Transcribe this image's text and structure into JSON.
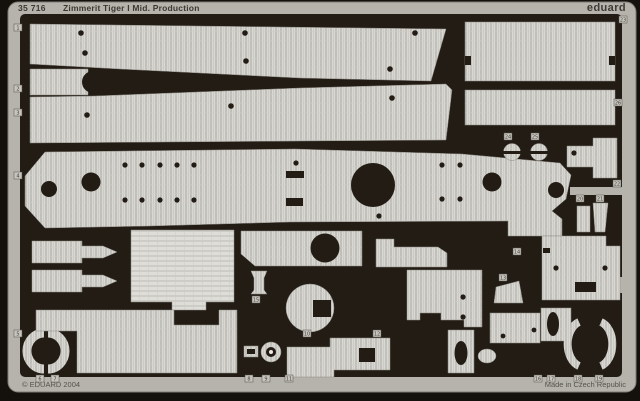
{
  "header": {
    "catalog_number": "35 716",
    "title": "Zimmerit Tiger I Mid. Production",
    "brand": "eduard"
  },
  "footer": {
    "copyright": "© EDUARD 2004",
    "made_in": "Made in Czech Republic"
  },
  "colors": {
    "background": "#14100c",
    "field": "#221c15",
    "frame": "#b5b3ab",
    "frame_edge": "#7d7b73",
    "part_light": "#d9d8d3",
    "part_ridge": "#a8a6a0",
    "text_dark": "#3c3933",
    "tag_fill": "#c6c4bd"
  },
  "etch": {
    "part_tags": [
      {
        "x": 14,
        "y": 24,
        "label": "1"
      },
      {
        "x": 14,
        "y": 85,
        "label": "2"
      },
      {
        "x": 14,
        "y": 109,
        "label": "3"
      },
      {
        "x": 14,
        "y": 172,
        "label": "4"
      },
      {
        "x": 14,
        "y": 330,
        "label": "5"
      },
      {
        "x": 36,
        "y": 375,
        "label": "6"
      },
      {
        "x": 51,
        "y": 375,
        "label": "7"
      },
      {
        "x": 245,
        "y": 375,
        "label": "8"
      },
      {
        "x": 262,
        "y": 375,
        "label": "9"
      },
      {
        "x": 303,
        "y": 330,
        "label": "10"
      },
      {
        "x": 285,
        "y": 375,
        "label": "11"
      },
      {
        "x": 373,
        "y": 330,
        "label": "12"
      },
      {
        "x": 499,
        "y": 274,
        "label": "13"
      },
      {
        "x": 513,
        "y": 248,
        "label": "14"
      },
      {
        "x": 252,
        "y": 296,
        "label": "15"
      },
      {
        "x": 534,
        "y": 375,
        "label": "16"
      },
      {
        "x": 547,
        "y": 375,
        "label": "17"
      },
      {
        "x": 574,
        "y": 375,
        "label": "18"
      },
      {
        "x": 595,
        "y": 375,
        "label": "19"
      },
      {
        "x": 576,
        "y": 195,
        "label": "20"
      },
      {
        "x": 596,
        "y": 195,
        "label": "21"
      },
      {
        "x": 613,
        "y": 180,
        "label": "22"
      },
      {
        "x": 619,
        "y": 16,
        "label": "23"
      },
      {
        "x": 504,
        "y": 133,
        "label": "24"
      },
      {
        "x": 531,
        "y": 133,
        "label": "25"
      },
      {
        "x": 614,
        "y": 99,
        "label": "26"
      }
    ],
    "shapes": [
      {
        "name": "roof-strip-upper",
        "kind": "poly",
        "pts": "30,24 446,29 431,81 300,78 120,69 30,64",
        "fill": "tex"
      },
      {
        "name": "hole",
        "kind": "circle",
        "cx": 81,
        "cy": 33,
        "r": 2.8,
        "fill": "dark"
      },
      {
        "name": "hole",
        "kind": "circle",
        "cx": 85,
        "cy": 53,
        "r": 2.8,
        "fill": "dark"
      },
      {
        "name": "hole",
        "kind": "circle",
        "cx": 245,
        "cy": 33,
        "r": 2.8,
        "fill": "dark"
      },
      {
        "name": "hole",
        "kind": "circle",
        "cx": 246,
        "cy": 61,
        "r": 2.8,
        "fill": "dark"
      },
      {
        "name": "hole",
        "kind": "circle",
        "cx": 415,
        "cy": 33,
        "r": 2.8,
        "fill": "dark"
      },
      {
        "name": "hole",
        "kind": "circle",
        "cx": 390,
        "cy": 69,
        "r": 2.8,
        "fill": "dark"
      },
      {
        "name": "bracket-part",
        "kind": "poly",
        "pts": "30,69 88,69 88,95 30,95",
        "fill": "tex"
      },
      {
        "name": "bracket-notch",
        "kind": "circle",
        "cx": 93,
        "cy": 82,
        "r": 11,
        "fill": "dark"
      },
      {
        "name": "roof-strip-lower",
        "kind": "poly",
        "pts": "30,97 95,96 300,88 446,84 452,90 446,140 300,141 30,143",
        "fill": "tex"
      },
      {
        "name": "hole",
        "kind": "circle",
        "cx": 87,
        "cy": 115,
        "r": 2.8,
        "fill": "dark"
      },
      {
        "name": "hole",
        "kind": "circle",
        "cx": 231,
        "cy": 106,
        "r": 2.8,
        "fill": "dark"
      },
      {
        "name": "hole",
        "kind": "circle",
        "cx": 392,
        "cy": 98,
        "r": 2.8,
        "fill": "dark"
      },
      {
        "name": "side-plate-upper",
        "kind": "rect",
        "x": 465,
        "y": 22,
        "w": 150,
        "h": 59,
        "fill": "tex"
      },
      {
        "name": "edge-notch",
        "kind": "rect",
        "x": 465,
        "y": 56,
        "w": 6,
        "h": 9,
        "fill": "dark"
      },
      {
        "name": "edge-notch",
        "kind": "rect",
        "x": 609,
        "y": 56,
        "w": 6,
        "h": 9,
        "fill": "dark"
      },
      {
        "name": "side-plate-lower",
        "kind": "rect",
        "x": 465,
        "y": 90,
        "w": 150,
        "h": 35,
        "fill": "tex"
      },
      {
        "name": "engine-deck-plate",
        "kind": "poly",
        "pts": "25,176 45,152 295,149 462,154 560,163 571,175 566,199 552,211 562,219 562,236 508,236 508,221 290,222 150,226 45,228 25,206",
        "fill": "tex"
      },
      {
        "name": "hole",
        "kind": "circle",
        "cx": 49,
        "cy": 189,
        "r": 8,
        "fill": "dark"
      },
      {
        "name": "hole",
        "kind": "circle",
        "cx": 91,
        "cy": 182,
        "r": 9.5,
        "fill": "dark"
      },
      {
        "name": "fan-opening",
        "kind": "circle",
        "cx": 373,
        "cy": 185,
        "r": 22,
        "fill": "dark"
      },
      {
        "name": "hole",
        "kind": "circle",
        "cx": 492,
        "cy": 182,
        "r": 9.5,
        "fill": "dark"
      },
      {
        "name": "hole",
        "kind": "circle",
        "cx": 556,
        "cy": 190,
        "r": 8,
        "fill": "dark"
      },
      {
        "name": "hole",
        "kind": "circle",
        "cx": 125,
        "cy": 165,
        "r": 2.6,
        "fill": "dark"
      },
      {
        "name": "hole",
        "kind": "circle",
        "cx": 142,
        "cy": 165,
        "r": 2.6,
        "fill": "dark"
      },
      {
        "name": "hole",
        "kind": "circle",
        "cx": 160,
        "cy": 165,
        "r": 2.6,
        "fill": "dark"
      },
      {
        "name": "hole",
        "kind": "circle",
        "cx": 177,
        "cy": 165,
        "r": 2.6,
        "fill": "dark"
      },
      {
        "name": "hole",
        "kind": "circle",
        "cx": 194,
        "cy": 165,
        "r": 2.6,
        "fill": "dark"
      },
      {
        "name": "hole",
        "kind": "circle",
        "cx": 125,
        "cy": 200,
        "r": 2.6,
        "fill": "dark"
      },
      {
        "name": "hole",
        "kind": "circle",
        "cx": 142,
        "cy": 200,
        "r": 2.6,
        "fill": "dark"
      },
      {
        "name": "hole",
        "kind": "circle",
        "cx": 160,
        "cy": 200,
        "r": 2.6,
        "fill": "dark"
      },
      {
        "name": "hole",
        "kind": "circle",
        "cx": 177,
        "cy": 200,
        "r": 2.6,
        "fill": "dark"
      },
      {
        "name": "hole",
        "kind": "circle",
        "cx": 194,
        "cy": 200,
        "r": 2.6,
        "fill": "dark"
      },
      {
        "name": "hole",
        "kind": "circle",
        "cx": 296,
        "cy": 163,
        "r": 2.6,
        "fill": "dark"
      },
      {
        "name": "hole",
        "kind": "circle",
        "cx": 442,
        "cy": 165,
        "r": 2.6,
        "fill": "dark"
      },
      {
        "name": "hole",
        "kind": "circle",
        "cx": 460,
        "cy": 165,
        "r": 2.6,
        "fill": "dark"
      },
      {
        "name": "hole",
        "kind": "circle",
        "cx": 442,
        "cy": 199,
        "r": 2.6,
        "fill": "dark"
      },
      {
        "name": "hole",
        "kind": "circle",
        "cx": 460,
        "cy": 199,
        "r": 2.6,
        "fill": "dark"
      },
      {
        "name": "hole",
        "kind": "circle",
        "cx": 379,
        "cy": 216,
        "r": 2.6,
        "fill": "dark"
      },
      {
        "name": "slot",
        "kind": "rect",
        "x": 286,
        "y": 171,
        "w": 18,
        "h": 7,
        "fill": "dark"
      },
      {
        "name": "slot",
        "kind": "rect",
        "x": 286,
        "y": 198,
        "w": 17,
        "h": 8,
        "fill": "dark"
      },
      {
        "name": "periscope-disc",
        "kind": "circle",
        "cx": 512,
        "cy": 152,
        "r": 8.5,
        "fill": "tex"
      },
      {
        "name": "disc-slot",
        "kind": "rect",
        "x": 503,
        "y": 151,
        "w": 18,
        "h": 3,
        "fill": "dark"
      },
      {
        "name": "periscope-disc",
        "kind": "circle",
        "cx": 539,
        "cy": 152,
        "r": 8.5,
        "fill": "tex"
      },
      {
        "name": "disc-slot",
        "kind": "rect",
        "x": 530,
        "y": 151,
        "w": 18,
        "h": 3,
        "fill": "dark"
      },
      {
        "name": "tee-part",
        "kind": "poly",
        "pts": "593,138 617,138 617,178 593,178 593,167 567,167 567,146 593,146",
        "fill": "tex"
      },
      {
        "name": "hole",
        "kind": "circle",
        "cx": 574,
        "cy": 153,
        "r": 2.6,
        "fill": "dark"
      },
      {
        "name": "small-rect-part",
        "kind": "rect",
        "x": 577,
        "y": 206,
        "w": 13,
        "h": 26,
        "fill": "tex"
      },
      {
        "name": "wedge-part",
        "kind": "poly",
        "pts": "593,203 608,203 605,232 595,232",
        "fill": "tex"
      },
      {
        "name": "exhaust-cover-upper",
        "kind": "poly",
        "pts": "32,241 82,241 82,246 103,246 117,252 103,258 82,258 82,263 32,263",
        "fill": "tex"
      },
      {
        "name": "exhaust-cover-lower",
        "kind": "poly",
        "pts": "32,270 82,270 82,275 103,275 117,281 103,287 82,287 82,292 32,292",
        "fill": "tex"
      },
      {
        "name": "large-square-plate",
        "kind": "poly",
        "pts": "131,230 234,230 234,302 206,302 206,310 172,310 172,302 131,302",
        "fill": "tex2"
      },
      {
        "name": "fan-cover-plate",
        "kind": "poly",
        "pts": "241,231 362,231 362,266 255,266 241,254",
        "fill": "tex"
      },
      {
        "name": "hole",
        "kind": "circle",
        "cx": 325,
        "cy": 248,
        "r": 14.5,
        "fill": "dark"
      },
      {
        "name": "small-bottle-part",
        "kind": "poly",
        "pts": "251,271 267,271 264,278 264,290 267,294 251,294 254,290 254,278",
        "fill": "tex"
      },
      {
        "name": "round-cover-part",
        "kind": "circle",
        "cx": 310,
        "cy": 308,
        "r": 24,
        "fill": "tex"
      },
      {
        "name": "square-cutout",
        "kind": "rect",
        "x": 313,
        "y": 300,
        "w": 18,
        "h": 17,
        "fill": "dark"
      },
      {
        "name": "notched-plate",
        "kind": "poly",
        "pts": "376,239 394,239 394,247 438,247 447,253 447,267 376,267",
        "fill": "tex"
      },
      {
        "name": "hatch-plate",
        "kind": "poly",
        "pts": "407,270 482,270 482,327 464,327 464,320 441,320 441,313 420,313 420,320 407,320",
        "fill": "tex"
      },
      {
        "name": "hole",
        "kind": "circle",
        "cx": 463,
        "cy": 297,
        "r": 2.6,
        "fill": "dark"
      },
      {
        "name": "hole",
        "kind": "circle",
        "cx": 463,
        "cy": 317,
        "r": 2.6,
        "fill": "dark"
      },
      {
        "name": "curved-wedge-part",
        "kind": "poly",
        "pts": "496,287 519,281 523,303 494,303",
        "fill": "tex"
      },
      {
        "name": "rear-plate",
        "kind": "poly",
        "pts": "542,236 606,236 606,246 620,246 620,300 542,300",
        "fill": "tex"
      },
      {
        "name": "corner-notch",
        "kind": "rect",
        "x": 543,
        "y": 248,
        "w": 7,
        "h": 5,
        "fill": "dark"
      },
      {
        "name": "hole",
        "kind": "circle",
        "cx": 556,
        "cy": 268,
        "r": 2.6,
        "fill": "dark"
      },
      {
        "name": "hole",
        "kind": "circle",
        "cx": 605,
        "cy": 268,
        "r": 2.6,
        "fill": "dark"
      },
      {
        "name": "slot",
        "kind": "rect",
        "x": 575,
        "y": 282,
        "w": 21,
        "h": 10,
        "fill": "dark"
      },
      {
        "name": "fender-arc-left",
        "kind": "arc",
        "d": "M44,333 A17,18 0 0 0 44,369",
        "w": 9,
        "fill": "tex"
      },
      {
        "name": "fender-arc-right",
        "kind": "arc",
        "d": "M48,333 A17,18 0 0 1 48,369",
        "w": 9,
        "fill": "tex"
      },
      {
        "name": "bottom-left-plate",
        "kind": "poly",
        "pts": "36,310 174,310 174,325 219,325 219,310 237,310 237,373 77,373 77,331 36,331",
        "fill": "tex"
      },
      {
        "name": "small-slotted-part",
        "kind": "rect",
        "x": 244,
        "y": 346,
        "w": 14,
        "h": 11,
        "fill": "tex"
      },
      {
        "name": "slot",
        "kind": "rect",
        "x": 247,
        "y": 349,
        "w": 8,
        "h": 5,
        "fill": "dark"
      },
      {
        "name": "washer-part",
        "kind": "circle",
        "cx": 271,
        "cy": 352,
        "r": 10,
        "fill": "tex"
      },
      {
        "name": "washer-hole",
        "kind": "circle",
        "cx": 271,
        "cy": 352,
        "r": 5,
        "fill": "dark"
      },
      {
        "name": "washer-center",
        "kind": "circle",
        "cx": 271,
        "cy": 352,
        "r": 2,
        "fill": "light"
      },
      {
        "name": "bottom-center-plate",
        "kind": "poly",
        "pts": "287,347 330,347 330,338 390,338 390,370 334,370 334,377 287,377",
        "fill": "tex"
      },
      {
        "name": "plate-notch",
        "kind": "rect",
        "x": 359,
        "y": 348,
        "w": 16,
        "h": 14,
        "fill": "dark"
      },
      {
        "name": "oval-hole-part",
        "kind": "poly",
        "pts": "448,330 474,330 474,373 448,373",
        "fill": "tex"
      },
      {
        "name": "oval-cutout",
        "kind": "ellipse",
        "cx": 461,
        "cy": 353,
        "rx": 6.5,
        "ry": 12,
        "fill": "dark"
      },
      {
        "name": "small-oval-part",
        "kind": "ellipse",
        "cx": 487,
        "cy": 356,
        "rx": 9,
        "ry": 7,
        "fill": "tex"
      },
      {
        "name": "bottom-plate-right",
        "kind": "rect",
        "x": 490,
        "y": 313,
        "w": 50,
        "h": 30,
        "fill": "tex"
      },
      {
        "name": "hole",
        "kind": "circle",
        "cx": 503,
        "cy": 336,
        "r": 2.4,
        "fill": "dark"
      },
      {
        "name": "hole",
        "kind": "circle",
        "cx": 534,
        "cy": 330,
        "r": 2.4,
        "fill": "dark"
      },
      {
        "name": "oval-hole-part-b",
        "kind": "rect",
        "x": 541,
        "y": 308,
        "w": 30,
        "h": 33,
        "fill": "tex"
      },
      {
        "name": "oval-cutout",
        "kind": "ellipse",
        "cx": 553,
        "cy": 324,
        "rx": 6,
        "ry": 12,
        "fill": "dark"
      },
      {
        "name": "fender-arc-left-b",
        "kind": "arc",
        "d": "M579,322 A16,23 0 0 0 579,366",
        "w": 8,
        "fill": "tex"
      },
      {
        "name": "fender-arc-right-b",
        "kind": "arc",
        "d": "M601,322 A16,23 0 0 1 601,366",
        "w": 8,
        "fill": "tex"
      }
    ]
  }
}
